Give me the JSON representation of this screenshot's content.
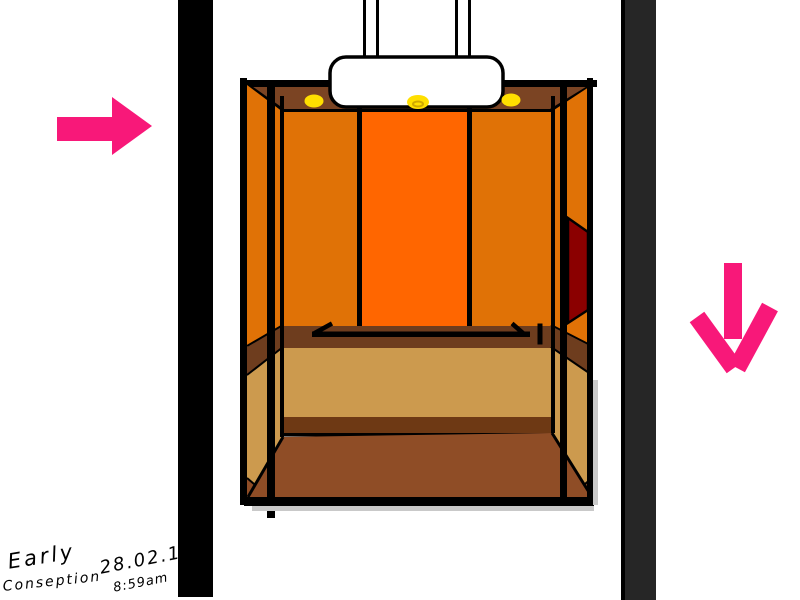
{
  "annotation": {
    "title_line1": "Early",
    "title_line2": "Conseption",
    "date": "28.02.14",
    "time": "8:59am"
  },
  "arrows": {
    "left_arrow_direction": "right",
    "right_arrow_direction": "down"
  },
  "lights_count": 3,
  "colors": {
    "paper": "#ffffff",
    "ink": "#000000",
    "shaft_left": "#000000",
    "shaft_right": "#262626",
    "housing": "#ffffff",
    "ceiling": "#7b4423",
    "wall_side": "#e07206",
    "wall_center": "#ff6600",
    "wainscot": "#6e3d1e",
    "lower_wall": "#cc9a4e",
    "step_edge": "#6e3914",
    "floor": "#8f4d26",
    "control_panel": "#8b0000",
    "light": "#ffdf00",
    "light_ring": "#cfa900",
    "arrow_pink": "#f81879",
    "shadow": "#c9c9c9"
  }
}
